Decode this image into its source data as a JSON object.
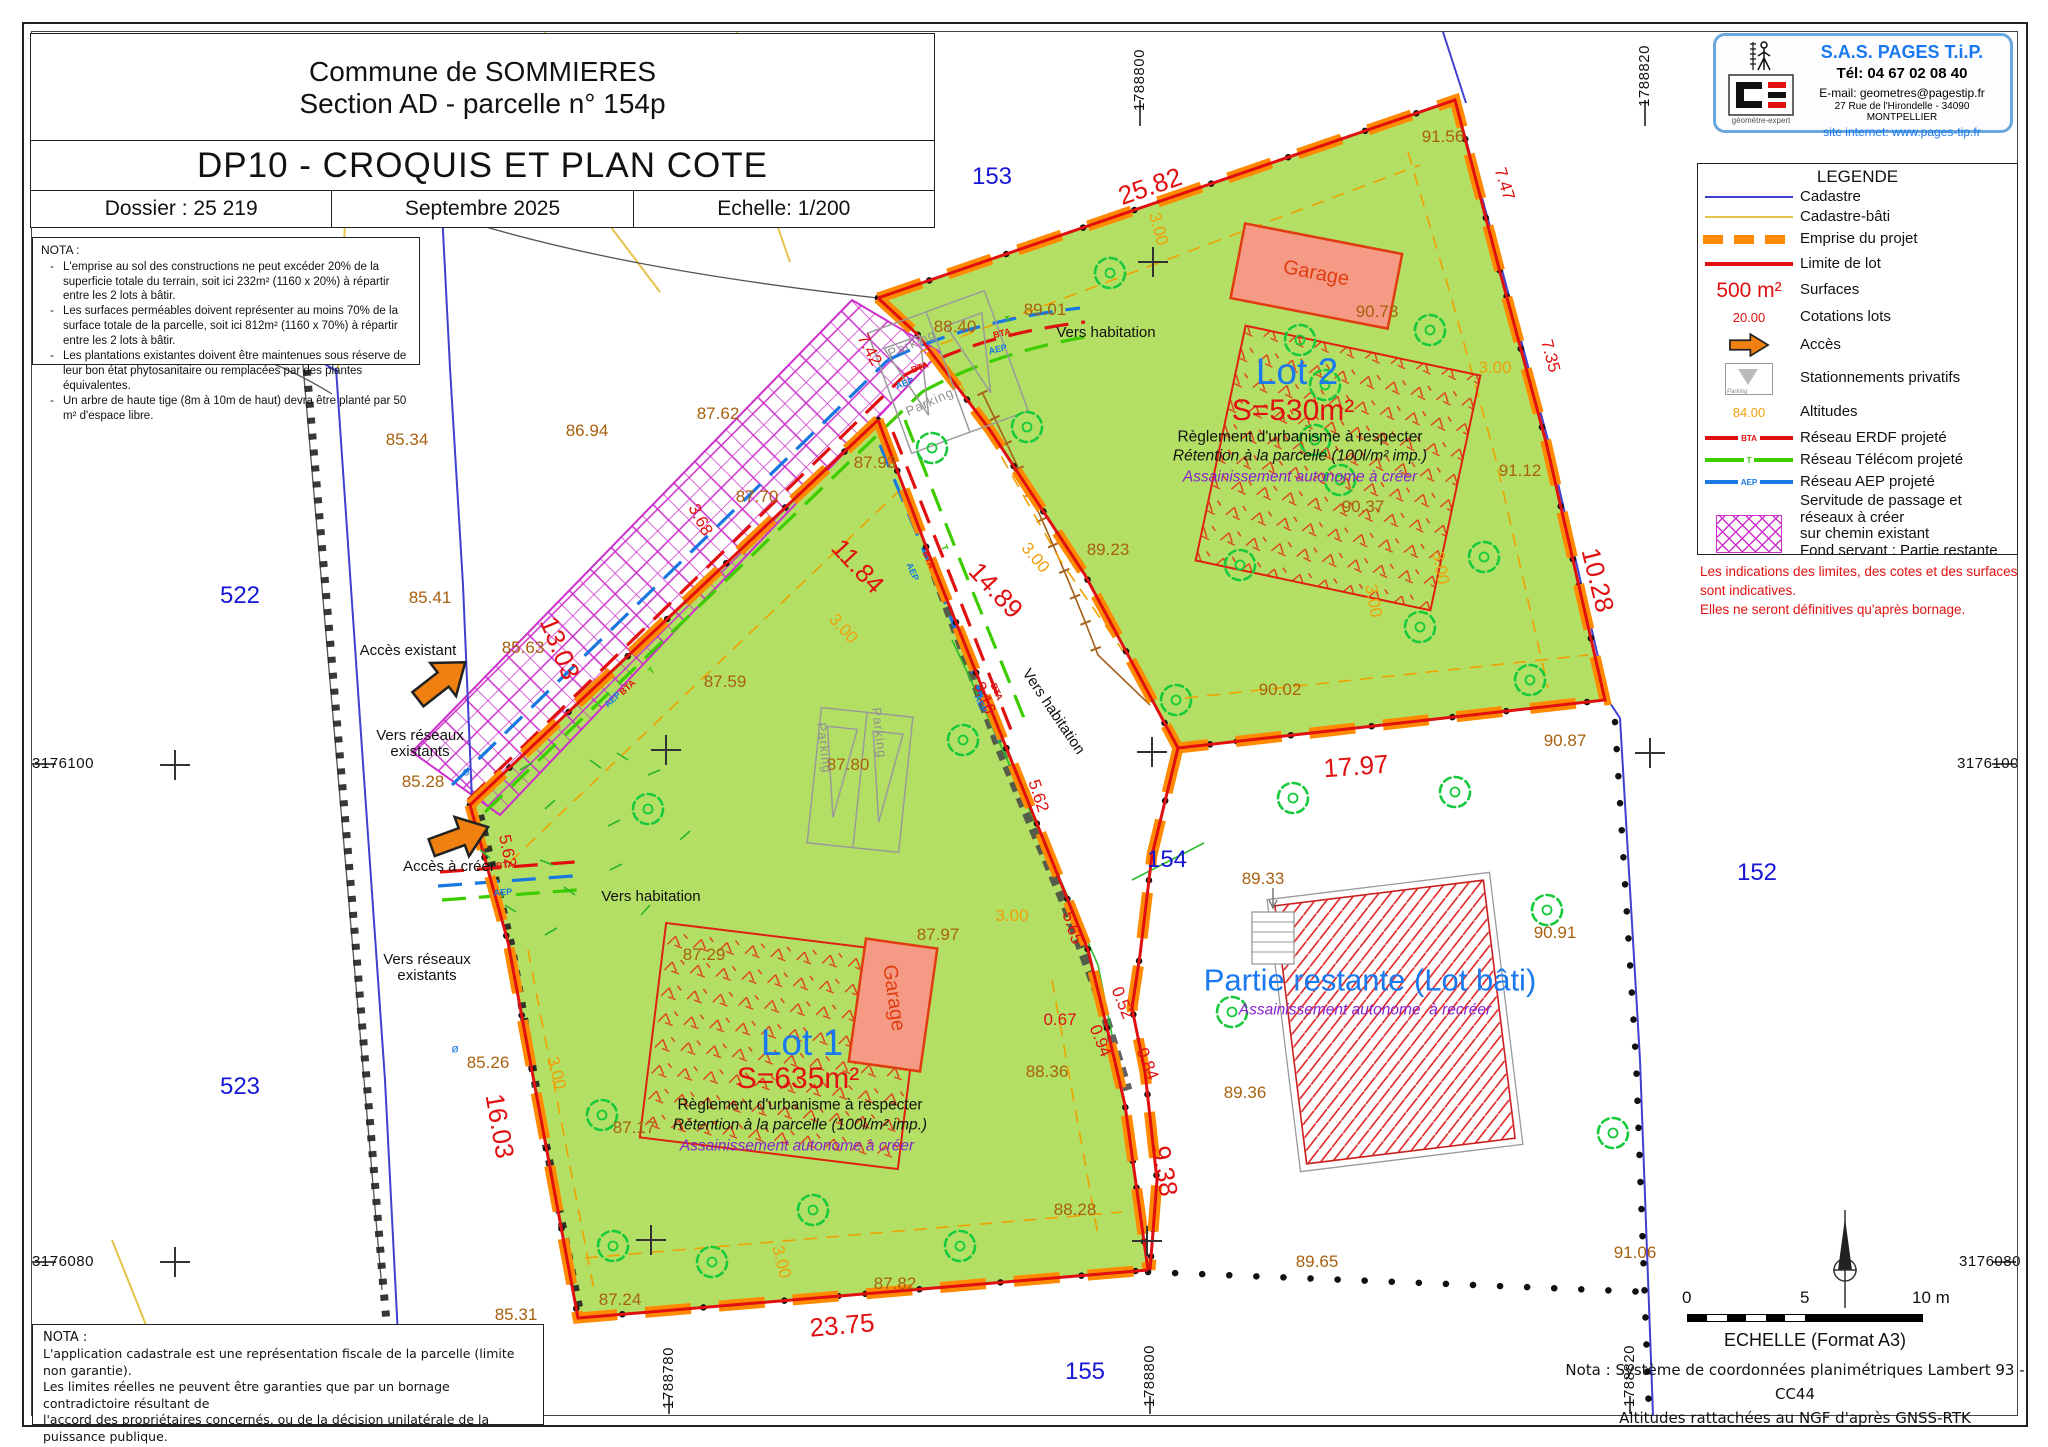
{
  "title_block": {
    "commune": "Commune de SOMMIERES",
    "section": "Section AD - parcelle n° 154p",
    "doc_title": "DP10 - CROQUIS ET PLAN COTE",
    "dossier": "Dossier : 25 219",
    "date": "Septembre 2025",
    "echelle": "Echelle: 1/200"
  },
  "nota_top": {
    "title": "NOTA :",
    "items": [
      "L'emprise au sol des constructions ne peut excéder 20% de la superficie totale du terrain, soit ici 232m² (1160 x 20%) à répartir entre les 2 lots à bâtir.",
      "Les surfaces perméables doivent représenter au moins 70% de la surface totale de la parcelle, soit ici 812m² (1160 x 70%) à répartir entre les 2 lots à bâtir.",
      "Les plantations existantes doivent être maintenues sous réserve de leur bon état phytosanitaire ou remplacées par des plantes équivalentes.",
      "Un arbre de haute tige (8m à 10m de haut) devra être planté par 50 m² d'espace libre."
    ]
  },
  "company": {
    "name": "S.A.S.  PAGES  T.i.P.",
    "tel": "Tél: 04 67 02 08 40",
    "email": "E-mail: geometres@pagestip.fr",
    "address": "27 Rue de l'Hirondelle - 34090 MONTPELLIER",
    "site": "site internet: www.pages-tip.fr",
    "logo_caption": "géomètre-expert"
  },
  "legend": {
    "title": "LEGENDE",
    "items": [
      {
        "swatch": "cadastre",
        "label": "Cadastre"
      },
      {
        "swatch": "bati",
        "label": "Cadastre-bâti"
      },
      {
        "swatch": "emprise",
        "label": "Emprise du projet"
      },
      {
        "swatch": "limite",
        "label": "Limite de lot"
      },
      {
        "swatch": "surface",
        "swatch_text": "500  m²",
        "label": "Surfaces"
      },
      {
        "swatch": "cote",
        "swatch_text": "20.00",
        "label": "Cotations lots"
      },
      {
        "swatch": "arrow",
        "label": "Accès"
      },
      {
        "swatch": "parking",
        "swatch_text": "Parking",
        "label": "Stationnements privatifs"
      },
      {
        "swatch": "alt",
        "swatch_text": "84.00",
        "label": "Altitudes"
      },
      {
        "swatch": "erdf",
        "swatch_text": "BTA",
        "label": "Réseau ERDF projeté"
      },
      {
        "swatch": "telecom",
        "swatch_text": "T",
        "label": "Réseau Télécom projeté"
      },
      {
        "swatch": "aep",
        "swatch_text": "AEP",
        "label": "Réseau AEP projeté"
      },
      {
        "swatch": "servitude",
        "label": "Servitude de passage et réseaux à créer\nsur chemin existant\nFond servant : Partie restante\nFond dominant : Lot 2"
      }
    ]
  },
  "legend_note": "Les indications des limites, des cotes et des surfaces sont indicatives.\nElles ne seront définitives qu'après bornage.",
  "nota_bottom": {
    "title": "NOTA :",
    "body": "L'application cadastrale est une représentation fiscale de la parcelle (limite non garantie).\nLes limites réelles ne peuvent être garanties que par un bornage contradictoire résultant de\nl'accord des propriétaires concernés, ou de la décision unilatérale de la puissance publique.\nLa contenance cadastrale n'a qu'une valeur indicative et fiscale, elle sert essentiellement au\ncalcul de l'impôt."
  },
  "scale_bar": {
    "zero": "0",
    "five": "5",
    "ten": "10 m",
    "caption": "ECHELLE (Format A3)"
  },
  "coord_note": {
    "line1": "Nota : Système de coordonnées planimétriques Lambert 93 - CC44",
    "line2": "Altitudes rattachées au NGF d'après GNSS-RTK"
  },
  "colors": {
    "lot_green": "#b3e064",
    "emprise_orange": "#ff8a00",
    "limite_red": "#e01010",
    "cadastre_blue": "#4040d0",
    "bati_gold": "#e6c34c",
    "servitude_magenta": "#cc2fcc",
    "altitude_brown": "#a8600f",
    "cote_orange": "#efa00b",
    "lot_blue": "#1b79f0",
    "purple": "#8822cc",
    "garage_salmon": "#f59b85",
    "tree_green": "#17c93c"
  },
  "plan": {
    "labels": [
      {
        "t": "153",
        "x": 992,
        "y": 177,
        "c": "p"
      },
      {
        "t": "522",
        "x": 240,
        "y": 596,
        "c": "p"
      },
      {
        "t": "523",
        "x": 240,
        "y": 1087,
        "c": "p"
      },
      {
        "t": "152",
        "x": 1757,
        "y": 873,
        "c": "p"
      },
      {
        "t": "154",
        "x": 1167,
        "y": 860,
        "c": "p"
      },
      {
        "t": "155",
        "x": 1085,
        "y": 1372,
        "c": "p"
      },
      {
        "t": "1788800",
        "x": 1140,
        "y": 80,
        "c": "v",
        "r": -90
      },
      {
        "t": "1788820",
        "x": 1645,
        "y": 76,
        "c": "v",
        "r": -90
      },
      {
        "t": "1788780",
        "x": 669,
        "y": 1378,
        "c": "v",
        "r": -90
      },
      {
        "t": "1788800",
        "x": 1150,
        "y": 1376,
        "c": "v",
        "r": -90
      },
      {
        "t": "1788820",
        "x": 1630,
        "y": 1376,
        "c": "v",
        "r": -90
      },
      {
        "t": "3176100",
        "x": 63,
        "y": 764,
        "c": "h"
      },
      {
        "t": "3176100",
        "x": 1988,
        "y": 764,
        "c": "h"
      },
      {
        "t": "3176080",
        "x": 63,
        "y": 1262,
        "c": "h"
      },
      {
        "t": "3176080",
        "x": 1990,
        "y": 1262,
        "c": "h"
      },
      {
        "t": "91.56",
        "x": 1443,
        "y": 137,
        "c": "a"
      },
      {
        "t": "88.40",
        "x": 955,
        "y": 327,
        "c": "a"
      },
      {
        "t": "89.01",
        "x": 1045,
        "y": 310,
        "c": "a"
      },
      {
        "t": "90.73",
        "x": 1377,
        "y": 312,
        "c": "a"
      },
      {
        "t": "86.94",
        "x": 587,
        "y": 431,
        "c": "a"
      },
      {
        "t": "85.34",
        "x": 407,
        "y": 440,
        "c": "a"
      },
      {
        "t": "87.62",
        "x": 718,
        "y": 414,
        "c": "a"
      },
      {
        "t": "87.93",
        "x": 875,
        "y": 463,
        "c": "a"
      },
      {
        "t": "87.70",
        "x": 757,
        "y": 497,
        "c": "a"
      },
      {
        "t": "90.37",
        "x": 1363,
        "y": 507,
        "c": "a"
      },
      {
        "t": "89.23",
        "x": 1108,
        "y": 550,
        "c": "a"
      },
      {
        "t": "91.12",
        "x": 1520,
        "y": 471,
        "c": "a"
      },
      {
        "t": "85.41",
        "x": 430,
        "y": 598,
        "c": "a"
      },
      {
        "t": "85.63",
        "x": 523,
        "y": 648,
        "c": "a"
      },
      {
        "t": "87.59",
        "x": 725,
        "y": 682,
        "c": "a"
      },
      {
        "t": "90.02",
        "x": 1280,
        "y": 690,
        "c": "a"
      },
      {
        "t": "90.87",
        "x": 1565,
        "y": 741,
        "c": "a"
      },
      {
        "t": "85.28",
        "x": 423,
        "y": 782,
        "c": "a"
      },
      {
        "t": "87.80",
        "x": 848,
        "y": 765,
        "c": "a"
      },
      {
        "t": "89.33",
        "x": 1263,
        "y": 879,
        "c": "a"
      },
      {
        "t": "90.91",
        "x": 1555,
        "y": 933,
        "c": "a"
      },
      {
        "t": "87.29",
        "x": 704,
        "y": 955,
        "c": "a"
      },
      {
        "t": "87.97",
        "x": 938,
        "y": 935,
        "c": "a"
      },
      {
        "t": "88.36",
        "x": 1047,
        "y": 1072,
        "c": "a"
      },
      {
        "t": "87.17",
        "x": 634,
        "y": 1128,
        "c": "a"
      },
      {
        "t": "89.36",
        "x": 1245,
        "y": 1093,
        "c": "a"
      },
      {
        "t": "88.28",
        "x": 1075,
        "y": 1210,
        "c": "a"
      },
      {
        "t": "89.65",
        "x": 1317,
        "y": 1262,
        "c": "a"
      },
      {
        "t": "91.06",
        "x": 1635,
        "y": 1253,
        "c": "a"
      },
      {
        "t": "85.31",
        "x": 516,
        "y": 1315,
        "c": "a"
      },
      {
        "t": "87.24",
        "x": 620,
        "y": 1300,
        "c": "a"
      },
      {
        "t": "87.82",
        "x": 895,
        "y": 1284,
        "c": "a"
      },
      {
        "t": "85.26",
        "x": 488,
        "y": 1063,
        "c": "a"
      },
      {
        "t": "25.82",
        "x": 1150,
        "y": 186,
        "c": "D",
        "r": -19
      },
      {
        "t": "7.47",
        "x": 1504,
        "y": 184,
        "c": "d",
        "r": 73
      },
      {
        "t": "7.35",
        "x": 1550,
        "y": 356,
        "c": "d",
        "r": 75
      },
      {
        "t": "10.28",
        "x": 1598,
        "y": 580,
        "c": "D",
        "r": 76
      },
      {
        "t": "7.42",
        "x": 869,
        "y": 350,
        "c": "d",
        "r": 62
      },
      {
        "t": "3.68",
        "x": 700,
        "y": 520,
        "c": "d",
        "r": 62
      },
      {
        "t": "13.03",
        "x": 560,
        "y": 648,
        "c": "D",
        "r": 68
      },
      {
        "t": "11.84",
        "x": 858,
        "y": 566,
        "c": "D",
        "r": 47
      },
      {
        "t": "14.89",
        "x": 996,
        "y": 590,
        "c": "D",
        "r": 47
      },
      {
        "t": "3.16",
        "x": 984,
        "y": 698,
        "c": "d",
        "r": 68
      },
      {
        "t": "5.62",
        "x": 1038,
        "y": 796,
        "c": "d",
        "r": 72
      },
      {
        "t": "5.65",
        "x": 1072,
        "y": 928,
        "c": "d",
        "r": 72
      },
      {
        "t": "17.97",
        "x": 1356,
        "y": 766,
        "c": "D",
        "r": -4
      },
      {
        "t": "0.67",
        "x": 1060,
        "y": 1020,
        "c": "d"
      },
      {
        "t": "0.52",
        "x": 1122,
        "y": 1003,
        "c": "d",
        "r": 68
      },
      {
        "t": "0.94",
        "x": 1100,
        "y": 1041,
        "c": "d",
        "r": 68
      },
      {
        "t": "0.84",
        "x": 1147,
        "y": 1064,
        "c": "d",
        "r": 68
      },
      {
        "t": "9.38",
        "x": 1165,
        "y": 1171,
        "c": "D",
        "r": 80
      },
      {
        "t": "16.03",
        "x": 500,
        "y": 1126,
        "c": "D",
        "r": 80
      },
      {
        "t": "23.75",
        "x": 842,
        "y": 1325,
        "c": "D",
        "r": -5
      },
      {
        "t": "5.62",
        "x": 507,
        "y": 851,
        "c": "d",
        "r": 78
      },
      {
        "t": "3.00",
        "x": 1158,
        "y": 229,
        "c": "o",
        "r": 75
      },
      {
        "t": "3.00",
        "x": 1495,
        "y": 368,
        "c": "o"
      },
      {
        "t": "3.00",
        "x": 1440,
        "y": 568,
        "c": "o",
        "r": 80
      },
      {
        "t": "3.00",
        "x": 1373,
        "y": 601,
        "c": "o",
        "r": 80
      },
      {
        "t": "3.00",
        "x": 1035,
        "y": 558,
        "c": "o",
        "r": 50
      },
      {
        "t": "3.00",
        "x": 843,
        "y": 629,
        "c": "o",
        "r": 47
      },
      {
        "t": "3.00",
        "x": 1012,
        "y": 916,
        "c": "o"
      },
      {
        "t": "3.00",
        "x": 556,
        "y": 1073,
        "c": "o",
        "r": 75
      },
      {
        "t": "3.00",
        "x": 781,
        "y": 1262,
        "c": "o",
        "r": 75
      },
      {
        "t": "Vers habitation",
        "x": 1106,
        "y": 333,
        "c": "n"
      },
      {
        "t": "Vers habitation",
        "x": 651,
        "y": 897,
        "c": "n"
      },
      {
        "t": "Vers habitation",
        "x": 1053,
        "y": 712,
        "c": "n",
        "r": 56
      },
      {
        "t": "Accès existant",
        "x": 408,
        "y": 651,
        "c": "n"
      },
      {
        "t": "Vers réseaux\nexistants",
        "x": 420,
        "y": 744,
        "c": "n"
      },
      {
        "t": "Accès à créer",
        "x": 449,
        "y": 867,
        "c": "n"
      },
      {
        "t": "Vers réseaux\nexistants",
        "x": 427,
        "y": 968,
        "c": "n"
      },
      {
        "t": "Lot 2",
        "x": 1297,
        "y": 372,
        "c": "L"
      },
      {
        "t": "S=530m²",
        "x": 1293,
        "y": 411,
        "c": "S"
      },
      {
        "t": "Règlement d'urbanisme à respecter",
        "x": 1300,
        "y": 438,
        "c": "R"
      },
      {
        "t": "Rétention à la parcelle (100l/m² imp.)",
        "x": 1300,
        "y": 457,
        "c": "I"
      },
      {
        "t": "Assainissement autonome à créer",
        "x": 1300,
        "y": 478,
        "c": "U"
      },
      {
        "t": "Lot 1",
        "x": 802,
        "y": 1043,
        "c": "L"
      },
      {
        "t": "S=635m²",
        "x": 798,
        "y": 1079,
        "c": "S"
      },
      {
        "t": "Règlement d'urbanisme à respecter",
        "x": 800,
        "y": 1106,
        "c": "R"
      },
      {
        "t": "Rétention à la parcelle (100l/m² imp.)",
        "x": 800,
        "y": 1126,
        "c": "I"
      },
      {
        "t": "Assainissement autonome à créer",
        "x": 797,
        "y": 1147,
        "c": "U"
      },
      {
        "t": "Partie restante (Lot bâti)",
        "x": 1370,
        "y": 980,
        "c": "P"
      },
      {
        "t": "Assainissement autonome  à recréer",
        "x": 1365,
        "y": 1011,
        "c": "U"
      },
      {
        "t": "Garage",
        "x": 1316,
        "y": 274,
        "c": "G",
        "r": 11
      },
      {
        "t": "Garage",
        "x": 893,
        "y": 998,
        "c": "G",
        "r": 82
      },
      {
        "t": "Parking",
        "x": 912,
        "y": 344,
        "c": "K",
        "r": -24
      },
      {
        "t": "Parking",
        "x": 930,
        "y": 402,
        "c": "K",
        "r": -24
      },
      {
        "t": "Parking",
        "x": 824,
        "y": 748,
        "c": "K",
        "r": 83
      },
      {
        "t": "Parking",
        "x": 879,
        "y": 733,
        "c": "K",
        "r": 83
      },
      {
        "t": "BTA",
        "x": 1002,
        "y": 334,
        "c": "r",
        "r": -14
      },
      {
        "t": "AEP",
        "x": 998,
        "y": 350,
        "c": "b",
        "r": -14
      },
      {
        "t": "T",
        "x": 1008,
        "y": 320,
        "c": "g",
        "r": -14
      },
      {
        "t": "BTA",
        "x": 920,
        "y": 368,
        "c": "r",
        "r": -20
      },
      {
        "t": "AEP",
        "x": 905,
        "y": 384,
        "c": "b",
        "r": -20
      },
      {
        "t": "BTA",
        "x": 628,
        "y": 688,
        "c": "r",
        "r": -43
      },
      {
        "t": "AEP",
        "x": 613,
        "y": 700,
        "c": "b",
        "r": -43
      },
      {
        "t": "T",
        "x": 652,
        "y": 671,
        "c": "g",
        "r": -43
      },
      {
        "t": "BTA",
        "x": 928,
        "y": 560,
        "c": "r",
        "r": 66
      },
      {
        "t": "AEP",
        "x": 912,
        "y": 572,
        "c": "b",
        "r": 66
      },
      {
        "t": "T",
        "x": 944,
        "y": 548,
        "c": "g",
        "r": 66
      },
      {
        "t": "BTA",
        "x": 996,
        "y": 692,
        "c": "r",
        "r": 66
      },
      {
        "t": "AEP",
        "x": 980,
        "y": 704,
        "c": "b",
        "r": 66
      },
      {
        "t": "BTA",
        "x": 505,
        "y": 866,
        "c": "r",
        "r": -4
      },
      {
        "t": "AEP",
        "x": 503,
        "y": 893,
        "c": "b",
        "r": -4
      },
      {
        "t": "ø",
        "x": 466,
        "y": 772,
        "c": "y"
      },
      {
        "t": "ø",
        "x": 455,
        "y": 1049,
        "c": "y"
      }
    ]
  }
}
